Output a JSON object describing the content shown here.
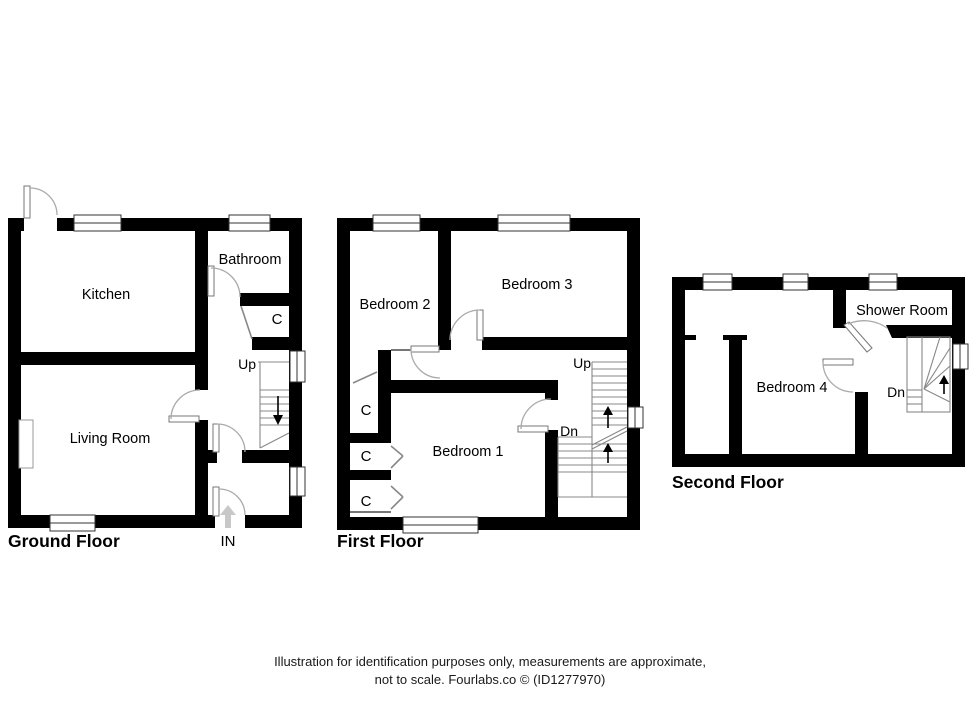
{
  "footer": {
    "line1": "Illustration for identification purposes only, measurements are approximate,",
    "line2": "not to scale. Fourlabs.co © (ID1277970)"
  },
  "floors": {
    "ground": {
      "title": "Ground Floor",
      "rooms": {
        "kitchen": "Kitchen",
        "bathroom": "Bathroom",
        "closet": "C",
        "living": "Living Room"
      },
      "stairs": {
        "up": "Up"
      },
      "entrance": "IN"
    },
    "first": {
      "title": "First Floor",
      "rooms": {
        "bedroom2": "Bedroom 2",
        "bedroom3": "Bedroom 3",
        "bedroom1": "Bedroom 1",
        "closet1": "C",
        "closet2": "C",
        "closet3": "C"
      },
      "stairs": {
        "up": "Up",
        "down": "Dn"
      }
    },
    "second": {
      "title": "Second Floor",
      "rooms": {
        "bedroom4": "Bedroom 4",
        "shower": "Shower Room"
      },
      "stairs": {
        "down": "Dn"
      }
    }
  },
  "colors": {
    "wall": "#000000",
    "background": "#ffffff",
    "door_arc": "#aaaaaa",
    "stair_line": "#888888"
  }
}
